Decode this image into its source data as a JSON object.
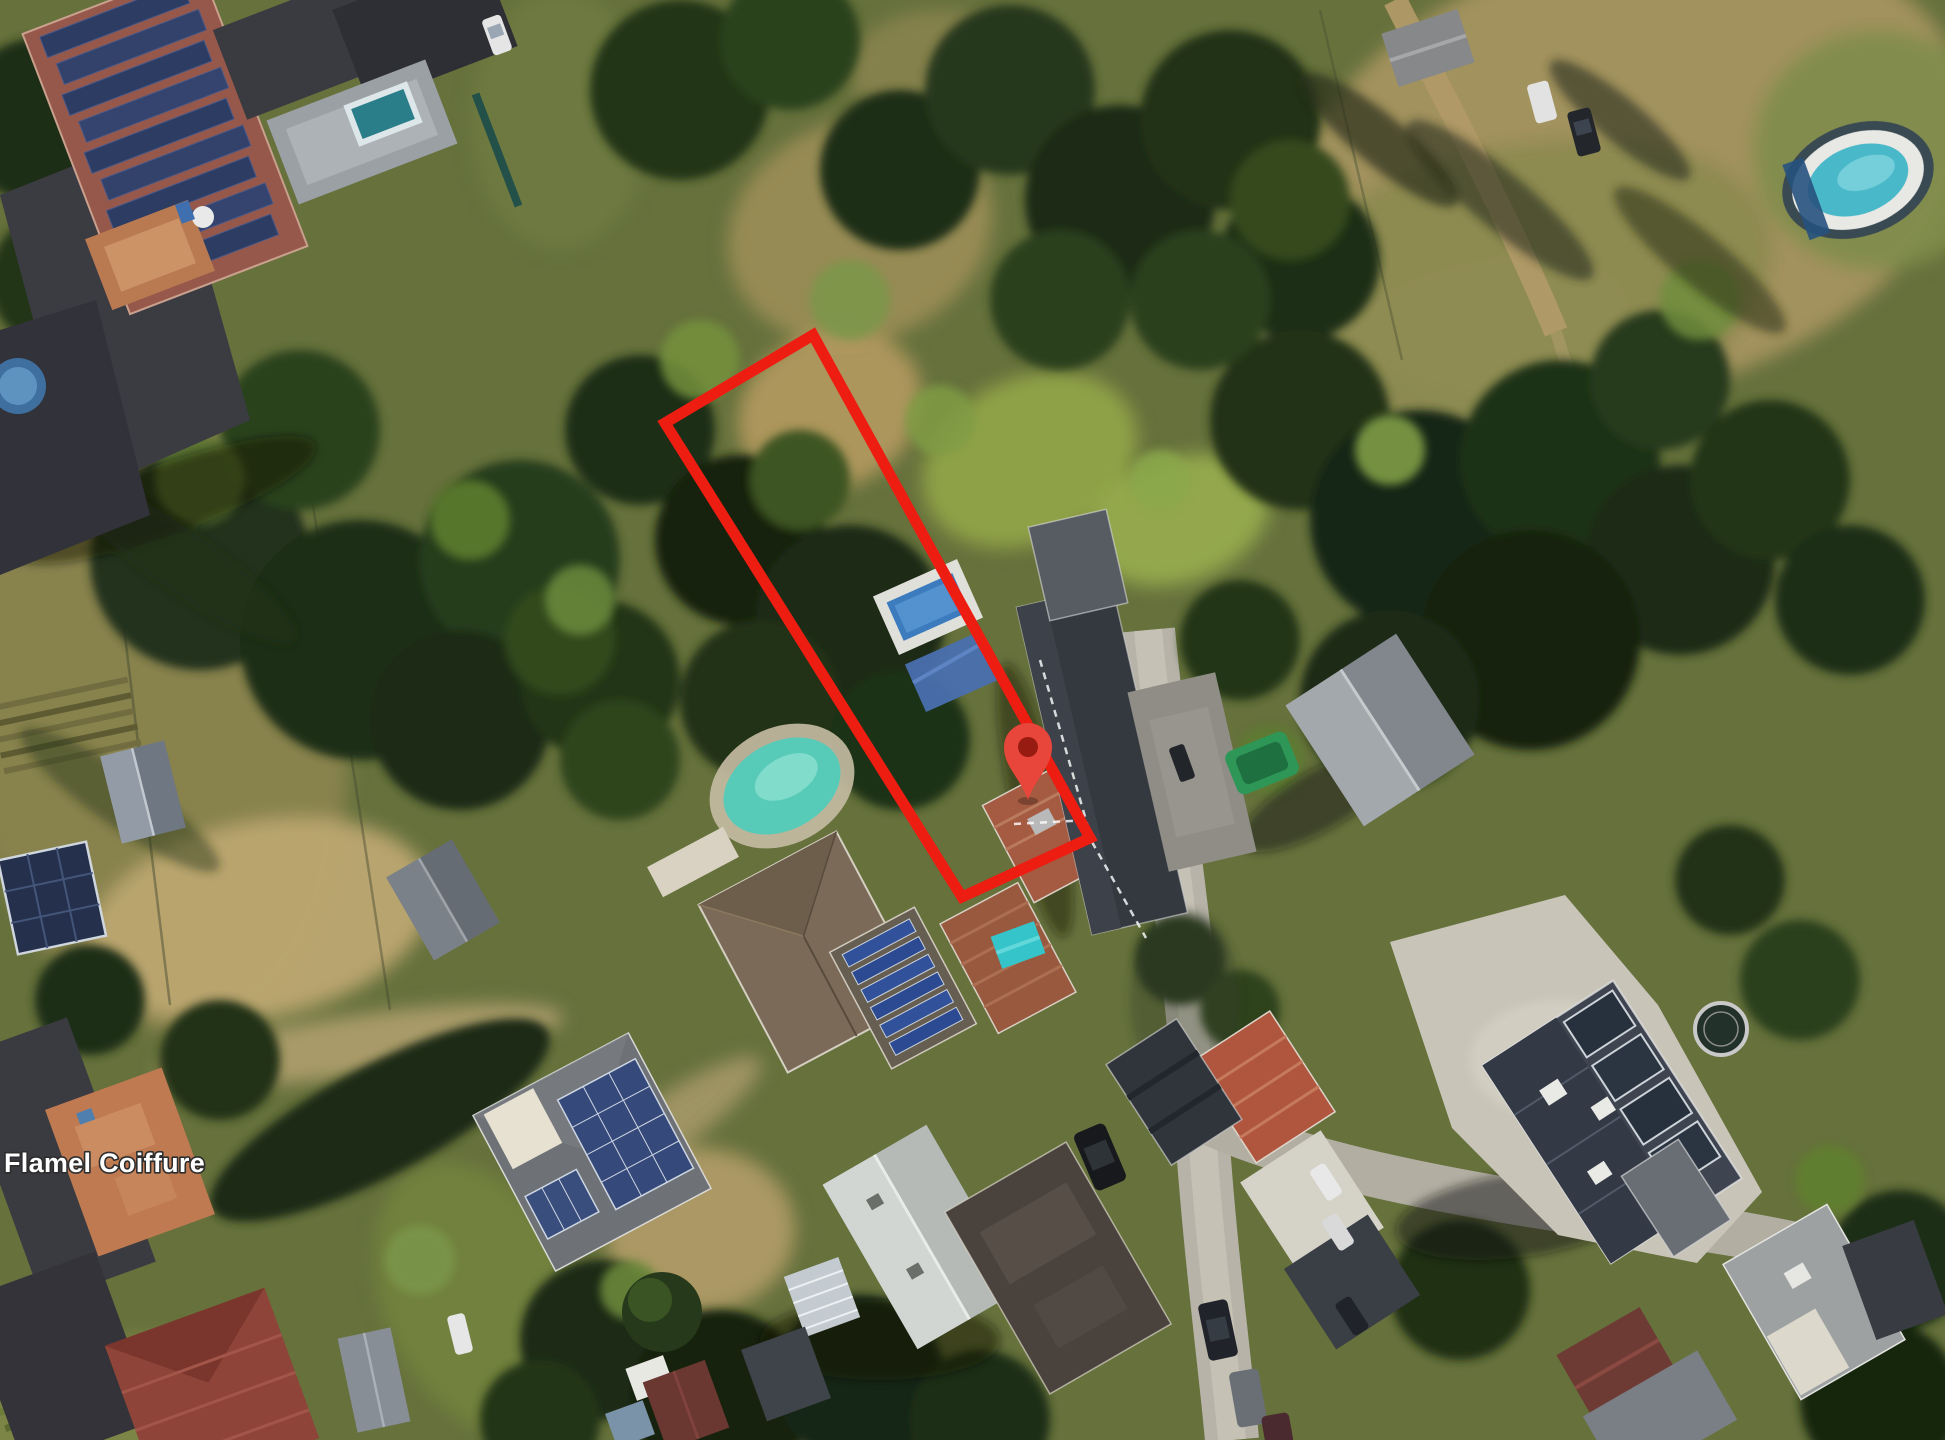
{
  "window": {
    "width": 1945,
    "height": 1440
  },
  "map": {
    "view": "satellite-aerial-imagery",
    "place_label": {
      "text": "Flamel Coiffure",
      "x": 4,
      "y": 1172,
      "font_size": 27,
      "fill": "#ffffff",
      "halo": "#2d2d2d"
    },
    "overlay": {
      "parcel": {
        "points": "813,335 665,423 962,897 1090,838",
        "color": "#ee1d12",
        "stroke_width": 11
      },
      "marker": {
        "transform": "translate(1028 747)",
        "body_color": "#e8453b",
        "dot_color": "#971b10"
      },
      "cadastral": {
        "color": "#ffffff",
        "dash": "7 6",
        "lines": [
          "1040,660 1090,834",
          "1014,824 1088,820",
          "1092,842 1146,938"
        ]
      }
    },
    "scene_features": [
      "solar-panel-roof-building",
      "dark-flat-roof-buildings",
      "terracotta-terrace",
      "kidney-swimming-pool",
      "rectangular-swimming-pool",
      "oval-swimming-pool",
      "small-round-pool",
      "garden-teal-pool",
      "blue-tarp",
      "cyan-tarp",
      "green-boat-tarp",
      "trampoline",
      "greenhouse",
      "gray-sheds",
      "ground-solar-array",
      "solar-roof-houses",
      "red-tile-roof-houses",
      "modern-flat-building",
      "white-gable-house",
      "warehouse-gable-roof",
      "street-north-south",
      "street-east-branch",
      "driveways",
      "parked-cars",
      "dense-trees",
      "tree-shadows",
      "dry-meadows",
      "lawns",
      "hedges",
      "garden-rows"
    ]
  }
}
